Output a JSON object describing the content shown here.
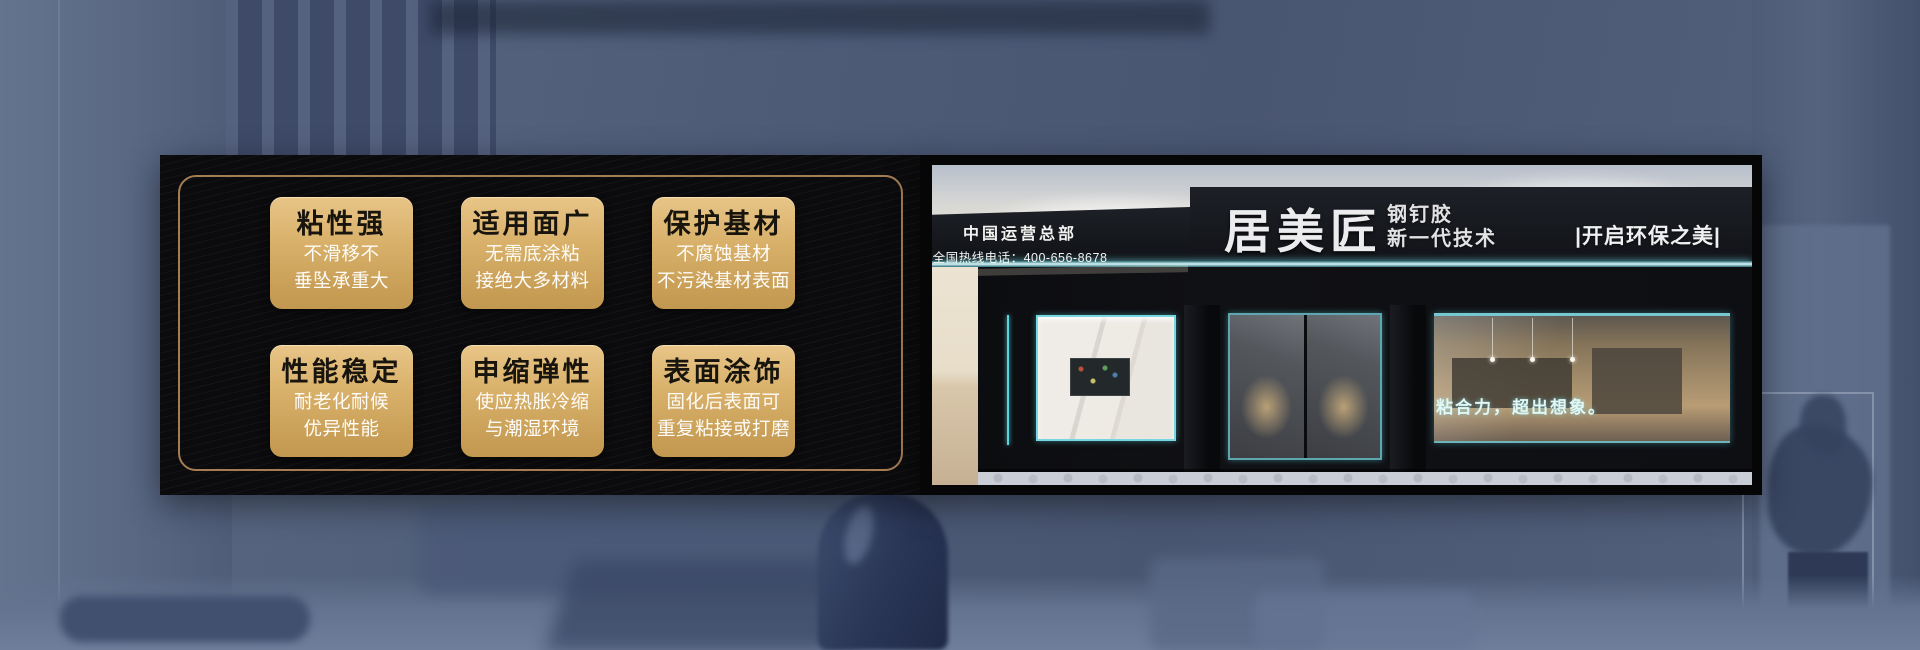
{
  "banner": {
    "features": [
      {
        "title": "粘性强",
        "line1": "不滑移不",
        "line2": "垂坠承重大"
      },
      {
        "title": "适用面广",
        "line1": "无需底涂粘",
        "line2": "接绝大多材料"
      },
      {
        "title": "保护基材",
        "line1": "不腐蚀基材",
        "line2": "不污染基材表面"
      },
      {
        "title": "性能稳定",
        "line1": "耐老化耐候",
        "line2": "优异性能"
      },
      {
        "title": "申缩弹性",
        "line1": "使应热胀冷缩",
        "line2": "与潮湿环境"
      },
      {
        "title": "表面涂饰",
        "line1": "固化后表面可",
        "line2": "重复粘接或打磨"
      }
    ]
  },
  "storefront": {
    "hq": "中国运营总部",
    "hotline": "全国热线电话：400-656-8678",
    "brand": "居美匠",
    "product": "钢钉胶",
    "tech": "新一代技术",
    "right_slogan": "|开启环保之美|",
    "window_slogan": "粘合力，超出想象。"
  },
  "colors": {
    "badge_gold_light": "#e8c588",
    "badge_gold_dark": "#c2974f",
    "gold_border": "#b5895a",
    "panel_black": "#0b0b0d",
    "led_cyan": "#5ad3e0",
    "background_blue": "#4d5b77",
    "sign_black": "#14161a",
    "badge_title_color": "#18140e",
    "badge_sub_color": "#fdfcf9"
  }
}
